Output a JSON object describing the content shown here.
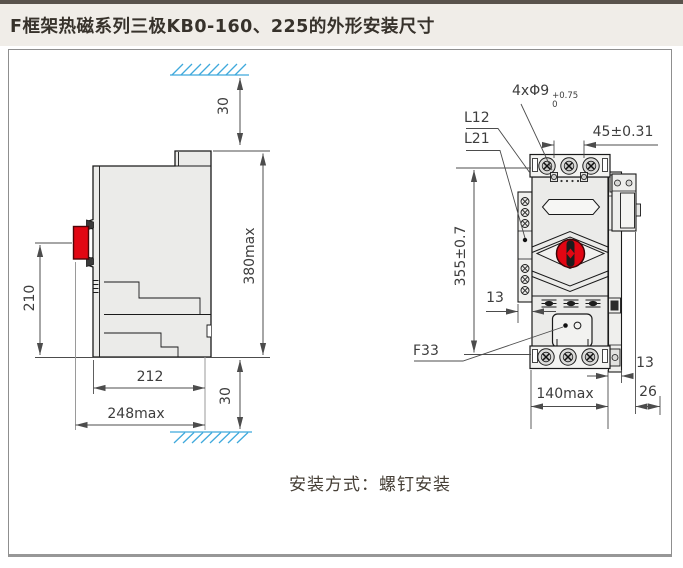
{
  "title": "F框架热磁系列三极KB0-160、225的外形安装尺寸",
  "note": "安装方式：螺钉安装",
  "side_view": {
    "top_clearance": "30",
    "overall_height": "380max",
    "handle_height": "210",
    "body_depth": "212",
    "overall_depth": "248max",
    "bottom_clearance": "30"
  },
  "front_view": {
    "mounting_holes": "4xΦ9",
    "hole_tol_upper": "+0.75",
    "hole_tol_lower": "0",
    "hole_pitch_horizontal": "45±0.31",
    "terminal_label_1": "L12",
    "terminal_label_2": "L21",
    "hole_pitch_vertical": "355±0.7",
    "left_rail_width": "13",
    "accessory_label": "F33",
    "overall_width": "140max",
    "right_rail_width": "13",
    "attachment_width": "26"
  },
  "colors": {
    "handle_red": "#e20613",
    "hatch_blue": "#3fa9dc",
    "body_fill": "#ebebe9"
  }
}
